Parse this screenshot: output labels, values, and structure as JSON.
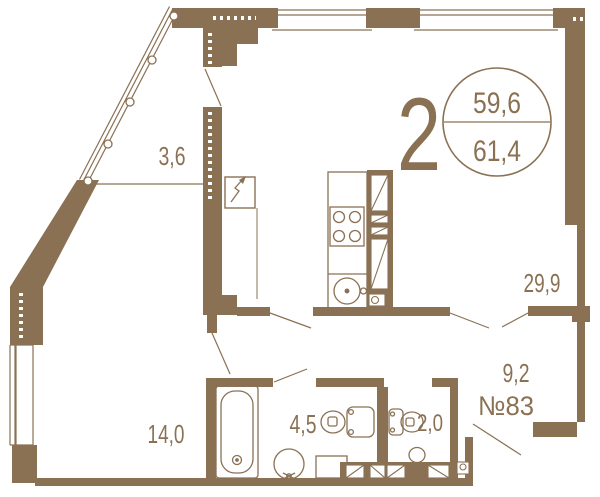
{
  "floorplan": {
    "badge": {
      "rooms_count": "2",
      "area_living": "59,6",
      "area_total": "61,4"
    },
    "apartment_number": "№83",
    "rooms": [
      {
        "name": "loggia",
        "area": "3,6"
      },
      {
        "name": "living-kitchen",
        "area": "29,9"
      },
      {
        "name": "bedroom",
        "area": "14,0"
      },
      {
        "name": "bathroom",
        "area": "4,5"
      },
      {
        "name": "wc",
        "area": "2,0"
      },
      {
        "name": "hallway",
        "area": "9,2"
      }
    ],
    "colors": {
      "wall": "#8a7154",
      "background": "#ffffff"
    }
  }
}
